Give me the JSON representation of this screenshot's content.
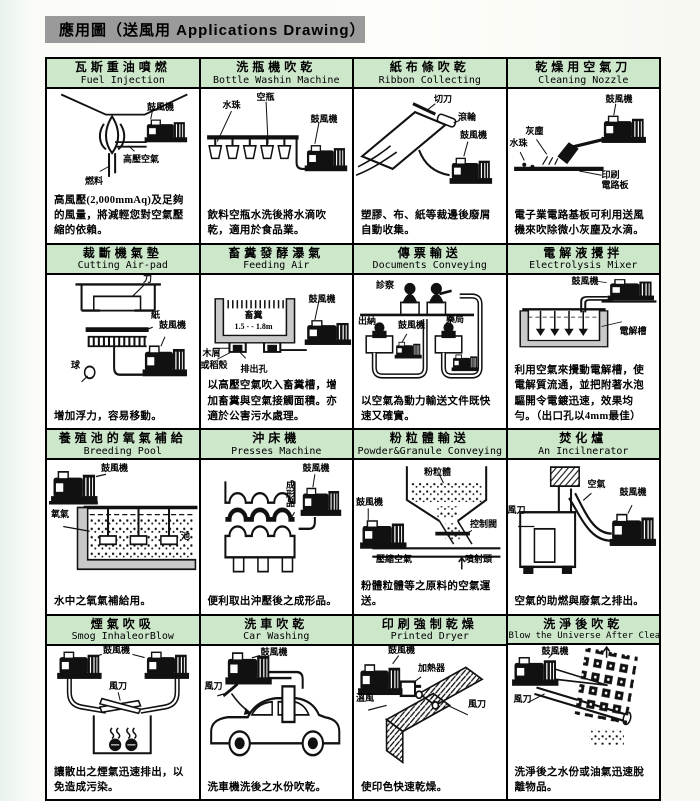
{
  "header": {
    "title": "應用圖（送風用 Applications Drawing）"
  },
  "colors": {
    "title_bar_bg": "#cde7cb",
    "header_bg": "#9a9a9a",
    "line": "#000000"
  },
  "cells": [
    {
      "title_zh": "瓦斯重油噴燃",
      "title_en": "Fuel Injection",
      "labels": [
        "鼓風機",
        "高壓空氣",
        "燃料"
      ],
      "desc": "高風壓(2,000mmAq)及足夠的風量，將減輕您對空氣壓縮的依賴。"
    },
    {
      "title_zh": "洗瓶機吹乾",
      "title_en": "Bottle Washin Machine",
      "labels": [
        "水珠",
        "空瓶",
        "鼓風機"
      ],
      "desc": "飲料空瓶水洗後將水滴吹乾，適用於食品業。"
    },
    {
      "title_zh": "紙布條吹乾",
      "title_en": "Ribbon Collecting",
      "labels": [
        "切刀",
        "滾輪",
        "鼓風機"
      ],
      "desc": "塑膠、布、紙等裁邊後廢屑自動收集。"
    },
    {
      "title_zh": "乾燥用空氣刀",
      "title_en": "Cleaning Nozzle",
      "labels": [
        "鼓風機",
        "灰塵",
        "水珠",
        "印刷\n電路板"
      ],
      "desc": "電子業電路基板可利用送風機來吹除微小灰塵及水滴。"
    },
    {
      "title_zh": "裁斷機氣墊",
      "title_en": "Cutting Air-pad",
      "labels": [
        "刀",
        "紙",
        "鼓風機",
        "球"
      ],
      "desc": "增加浮力，容易移動。"
    },
    {
      "title_zh": "畜糞發酵瀑氣",
      "title_en": "Feeding Air",
      "labels": [
        "畜糞",
        "1.5 - - 1.8m",
        "鼓風機",
        "木屑",
        "或稻殼",
        "排出孔"
      ],
      "desc": "以高壓空氣吹入畜糞槽，增加畜糞與空氣接觸面積。亦適於公害污水處理。"
    },
    {
      "title_zh": "傳票輸送",
      "title_en": "Documents Conveying",
      "labels": [
        "診察",
        "出納",
        "鼓風機",
        "藥局"
      ],
      "desc": "以空氣為動力輸送文件既快速又確實。"
    },
    {
      "title_zh": "電解液攪拌",
      "title_en": "Electrolysis Mixer",
      "labels": [
        "鼓風機",
        "電解槽"
      ],
      "desc": "利用空氣來攪動電解槽，使電解質流通，並把附著水泡驅開令電鍍迅速，效果均勻。（出口孔以4mm最佳）"
    },
    {
      "title_zh": "養殖池的氧氣補給",
      "title_en": "Breeding Pool",
      "labels": [
        "鼓風機",
        "氧氣",
        "池"
      ],
      "desc": "水中之氧氣補給用。"
    },
    {
      "title_zh": "沖床機",
      "title_en": "Presses Machine",
      "labels": [
        "鼓風機",
        "成形品"
      ],
      "desc": "便利取出沖壓後之成形品。"
    },
    {
      "title_zh": "粉粒體輸送",
      "title_en": "Powder&Granule Conveying",
      "labels": [
        "粉粒體",
        "鼓風機",
        "控制閥",
        "壓縮空氣",
        "噴射頭"
      ],
      "desc": "粉體粒體等之原料的空氣運送。"
    },
    {
      "title_zh": "焚化爐",
      "title_en": "An Incilnerator",
      "labels": [
        "空氣",
        "鼓風機",
        "風刀"
      ],
      "desc": "空氣的助燃與廢氣之排出。"
    },
    {
      "title_zh": "煙氣吹吸",
      "title_en": "Smog InhaleorBlow",
      "labels": [
        "鼓風機",
        "風刀"
      ],
      "desc": "讓散出之煙氣迅速排出，以免造成污染。"
    },
    {
      "title_zh": "洗車吹乾",
      "title_en": "Car Washing",
      "labels": [
        "鼓風機",
        "風刀"
      ],
      "desc": "洗車機洗後之水份吹乾。"
    },
    {
      "title_zh": "印刷強制乾燥",
      "title_en": "Printed Dryer",
      "labels": [
        "鼓風機",
        "加熱器",
        "溫風",
        "風刀"
      ],
      "desc": "使印色快速乾燥。"
    },
    {
      "title_zh": "洗淨後吹乾",
      "title_en": "Blow the Universe After Clean",
      "labels": [
        "鼓風機",
        "風刀"
      ],
      "desc": "洗淨後之水份或油氣迅速脫離物品。"
    }
  ]
}
